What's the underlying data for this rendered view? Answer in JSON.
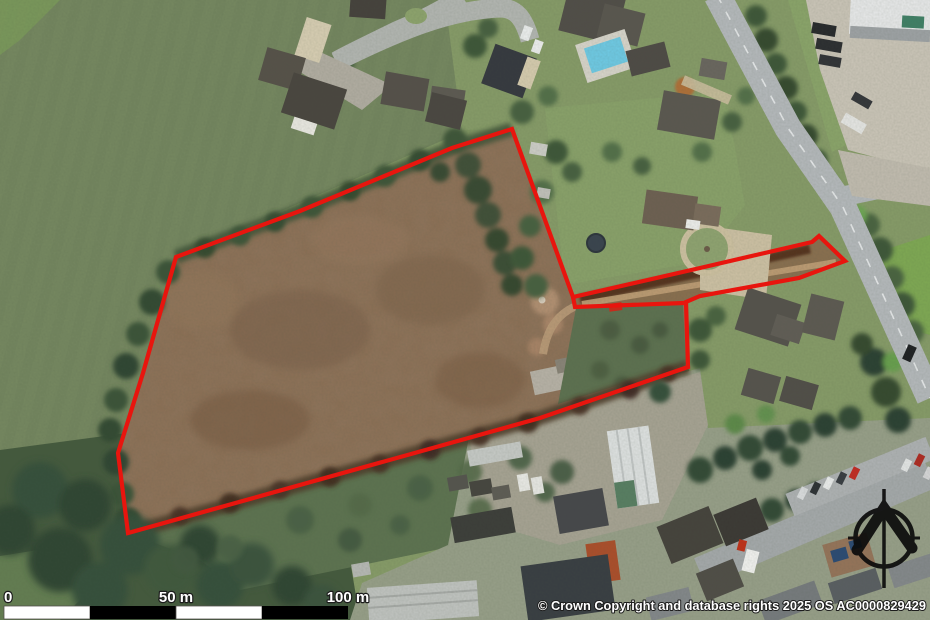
{
  "map": {
    "kind": "aerial-photo-site-plan",
    "attribution": "© Crown Copyright and database rights 2025 OS AC0000829429",
    "boundary": {
      "color": "#e8150e",
      "stroke_width": "4.2",
      "outline_points": "512,129 573,297 700,268 812,242 819,236 845,261 799,278 700,296 686,302 688,367 540,418 128,533 118,453 143,373 176,257 300,211 452,148",
      "spur_points": "573,297 575,307 684,303"
    },
    "scale_bar": {
      "labels": [
        "0",
        "50 m",
        "100 m"
      ],
      "segment_colors": [
        "#ffffff",
        "#000000",
        "#ffffff",
        "#000000"
      ]
    },
    "compass": {
      "type": "north-arrow"
    }
  }
}
